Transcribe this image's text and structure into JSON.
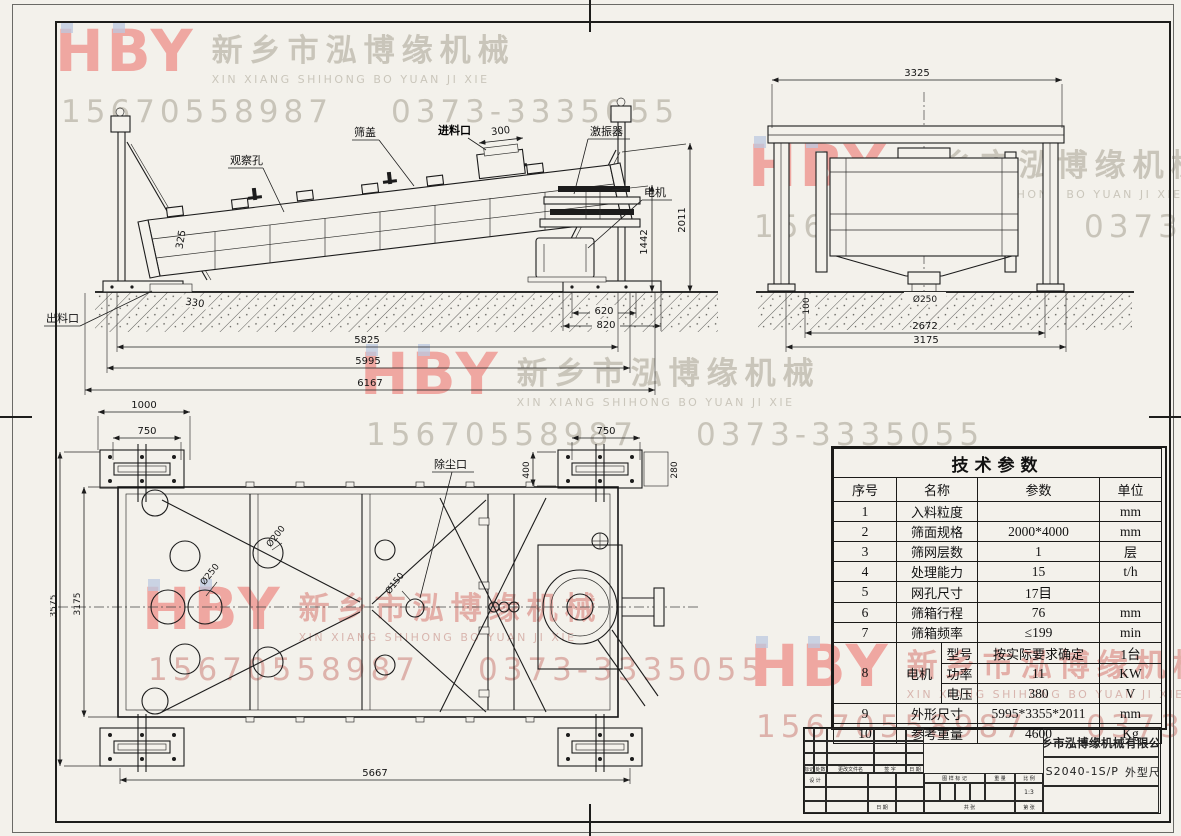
{
  "watermark": {
    "logo": "HBY",
    "cn": "新乡市泓博缘机械",
    "en": "XIN XIANG SHIHONG BO YUAN JI XIE",
    "phone1": "15670558987",
    "phone2": "0373-3335055"
  },
  "side_view": {
    "labels": {
      "observation": "观察孔",
      "cover": "筛盖",
      "feed": "进料口",
      "exciter": "激振器",
      "motor": "电机",
      "discharge": "出料口"
    },
    "dims": {
      "d300": "300",
      "d325": "325",
      "d330": "330",
      "d620": "620",
      "d820": "820",
      "d1442": "1442",
      "d2011": "2011",
      "d5825": "5825",
      "d5995": "5995",
      "d6167": "6167"
    }
  },
  "end_view": {
    "dims": {
      "d3325": "3325",
      "d250": "Ø250",
      "d100": "100",
      "d2672": "2672",
      "d3175": "3175"
    }
  },
  "plan_view": {
    "labels": {
      "dust": "除尘口"
    },
    "dims": {
      "d1000": "1000",
      "d750_left": "750",
      "d750_right": "750",
      "d400": "400",
      "d280": "280",
      "d3575": "3575",
      "d3175": "3175",
      "d5667": "5667",
      "d250": "Ø250",
      "d200": "Ø200",
      "d150": "Ø150"
    }
  },
  "spec_table": {
    "title": "技术参数",
    "headers": {
      "no": "序号",
      "name": "名称",
      "param": "参数",
      "unit": "单位"
    },
    "rows": [
      {
        "no": "1",
        "name": "入料粒度",
        "param": "",
        "unit": "mm"
      },
      {
        "no": "2",
        "name": "筛面规格",
        "param": "2000*4000",
        "unit": "mm"
      },
      {
        "no": "3",
        "name": "筛网层数",
        "param": "1",
        "unit": "层"
      },
      {
        "no": "4",
        "name": "处理能力",
        "param": "15",
        "unit": "t/h"
      },
      {
        "no": "5",
        "name": "网孔尺寸",
        "param": "17目",
        "unit": ""
      },
      {
        "no": "6",
        "name": "筛箱行程",
        "param": "76",
        "unit": "mm"
      },
      {
        "no": "7",
        "name": "筛箱频率",
        "param": "≤199",
        "unit": "min"
      }
    ],
    "motor_row": {
      "no": "8",
      "name": "电机",
      "subs": [
        {
          "key": "型号",
          "param": "按实际要求确定",
          "unit": "1台"
        },
        {
          "key": "功率",
          "param": "11",
          "unit": "KW"
        },
        {
          "key": "电压",
          "param": "380",
          "unit": "V"
        }
      ]
    },
    "tail_rows": [
      {
        "no": "9",
        "name": "外形尺寸",
        "param": "5995*3355*2011",
        "unit": "mm"
      },
      {
        "no": "10",
        "name": "参考重量",
        "param": "4600",
        "unit": "Kg"
      }
    ]
  },
  "title_block": {
    "company": "新乡市泓博缘机械有限公司",
    "drawing_no": "FHS2040-1S/P",
    "drawing_title": "外型尺寸",
    "rev": {
      "mark": "标记",
      "count": "处数",
      "file": "更改文件名",
      "sign": "签 字",
      "date": "日 期"
    },
    "design": "设 计",
    "date2": "日 期",
    "pattern_mark": "图 样 标 记",
    "weight": "重 量",
    "scale": "比 例",
    "scale_value": "1:3",
    "sheets_total": "共  张",
    "sheet_no": "第  张"
  }
}
